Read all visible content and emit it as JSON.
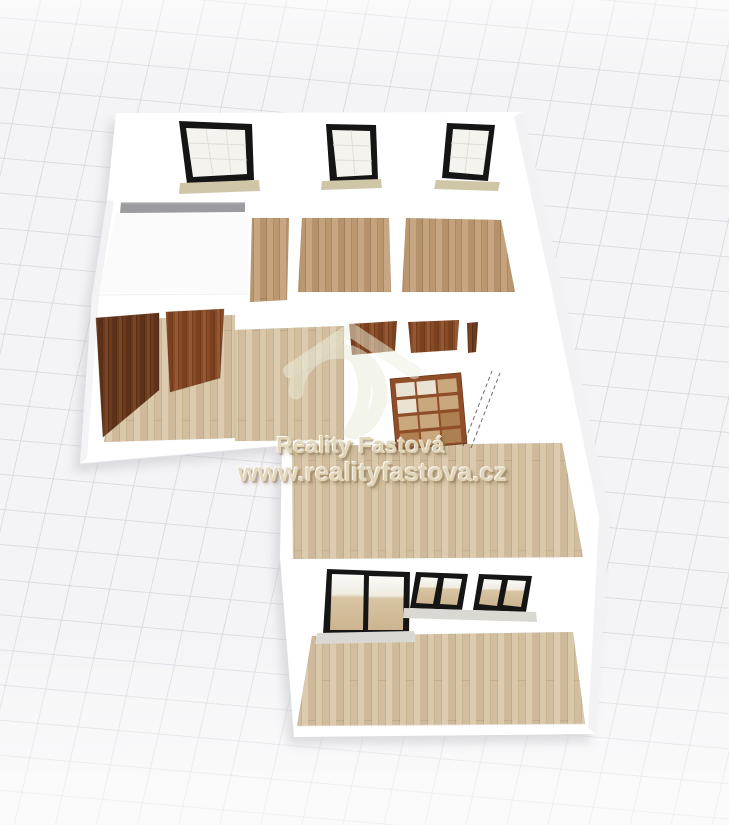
{
  "watermark": {
    "line1": "Reality Fastová",
    "line2": "www.realityfastova.cz"
  },
  "plan": {
    "back_wall_windows": 3,
    "hallway_doors": 2,
    "interior_door_tops": 3,
    "glazed_interior_doors": 1,
    "balcony_doors": 1,
    "balcony_windows": 2,
    "kitchen_counters": 1
  },
  "colors": {
    "bg_tile": "#f4f4f6",
    "wall": "#ffffff",
    "wall_shade": "#f1f1f4",
    "wood_dark": "#bf9a71",
    "wood_light": "#d6c2a1",
    "door_brown": "#8a4a24",
    "door_dark": "#6e3a1c",
    "frame_black": "#151515",
    "glass": "#f4f3ee",
    "sill_tan": "#cfc6a8",
    "sill_gray": "#d9d8d2",
    "counter": "#9c9ca0",
    "glazed_frame": "#8f4e28",
    "pane_cream": "#e9e3d3",
    "pane_tan": "#c8a87c",
    "pane_brown": "#ae7f50",
    "watermark": "#e3d7b9",
    "logo": "#e9ecd9",
    "dash": "#4a4a4a"
  }
}
